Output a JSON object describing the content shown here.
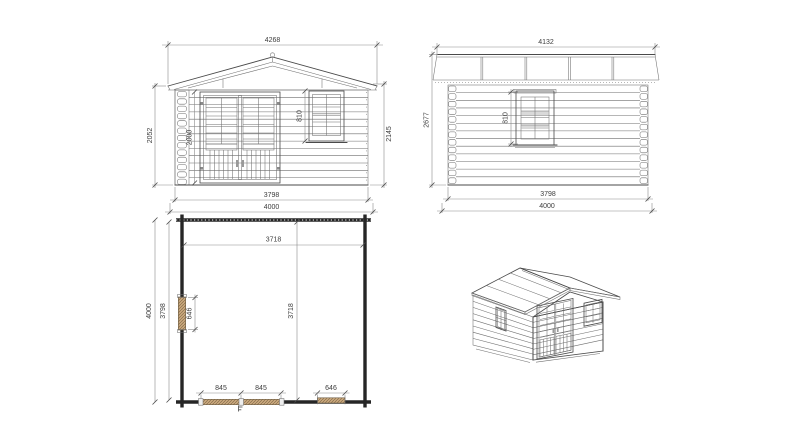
{
  "drawing": {
    "type": "log-cabin technical drawing, 4 views",
    "views": {
      "front_elevation": {
        "dims": {
          "roof_width": "4268",
          "wall_height_left": "2052",
          "door_height": "2000",
          "window_height": "810",
          "height_right": "2145",
          "wall_width": "3798",
          "base_width": "4000"
        }
      },
      "side_elevation": {
        "dims": {
          "roof_width": "4132",
          "total_height": "2677",
          "window_height": "810",
          "wall_depth": "3798",
          "base_depth": "4000"
        }
      },
      "floor_plan": {
        "dims": {
          "interior_width": "3718",
          "outer_depth": "4000",
          "inner_depth": "3798",
          "side_window_width": "646",
          "interior_depth": "3718",
          "door_leaf_left": "845",
          "door_leaf_right": "845",
          "front_window_width": "646"
        }
      },
      "isometric": {
        "label": "3d-perspective-view"
      }
    },
    "colors": {
      "line": "#4a4a4a",
      "dim_line": "#8a8a8a",
      "text": "#3d3d3d",
      "thick_wall": "#262626",
      "timber_fill": "#c9a87c",
      "timber_hatch": "#7a6245",
      "background": "#ffffff"
    }
  }
}
